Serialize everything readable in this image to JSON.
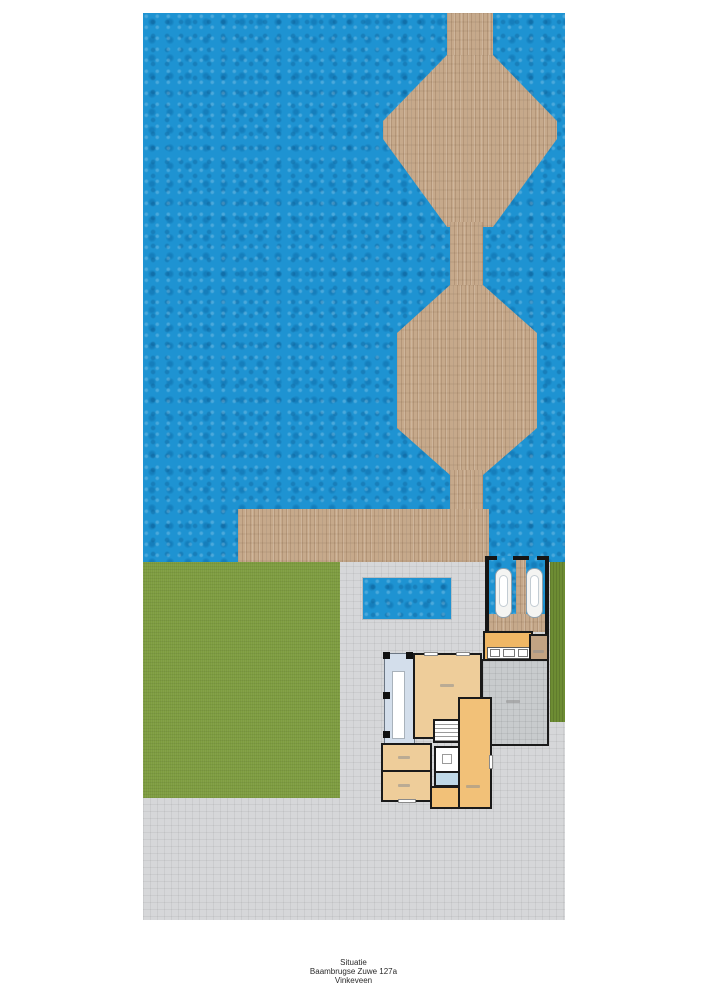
{
  "doc": {
    "type": "situation-site-plan",
    "title_block": {
      "line1": "Situatie",
      "line2": "Baambrugse Zuwe 127a",
      "line3": "Vinkeveen"
    }
  },
  "site": {
    "areas": [
      "water (lake)",
      "wooden deck island (top, octagon)",
      "wooden deck island (middle, hexagon)",
      "wooden walkways",
      "wooden jetty along shore",
      "grass garden (left)",
      "hedge strip (right)",
      "paved terrace / driveway",
      "swimming pool",
      "boathouse with two boat slips and two boats",
      "house ground floor with veranda, living rooms, bedrooms, bathroom, stairs",
      "garage",
      "storage room",
      "kitchen counter"
    ],
    "colors": {
      "water": "#1e93d2",
      "deck_wood": "#c6a98b",
      "grass": "#7d9c3f",
      "hedge": "#6d8c33",
      "pavement": "#d6d7d9",
      "garage_floor": "#c8cbcd",
      "room_tan": "#eecd9a",
      "room_orange": "#f2c178",
      "kitchen_orange": "#f0b765",
      "veranda_blue": "#d3deeb",
      "bathroom_blue": "#bfd8e7",
      "storage_tan": "#c2a383",
      "walls": "#1a1a1a",
      "boats": "#f4f4f2"
    }
  }
}
